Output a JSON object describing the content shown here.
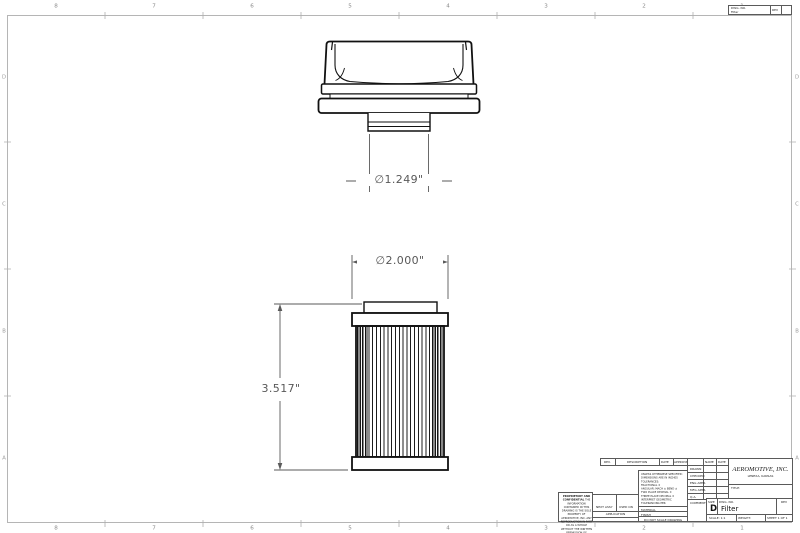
{
  "dimensions": {
    "cap_diameter": "∅1.249\"",
    "element_diameter": "∅2.000\"",
    "element_height": "3.517\""
  },
  "zones": {
    "top": [
      "8",
      "7",
      "6",
      "5",
      "4",
      "3",
      "2",
      "1"
    ],
    "bottom": [
      "8",
      "7",
      "6",
      "5",
      "4",
      "3",
      "2",
      "1"
    ],
    "left": [
      "D",
      "C",
      "B",
      "A"
    ],
    "right": [
      "D",
      "C",
      "B",
      "A"
    ]
  },
  "mini_strip": {
    "dwg_label": "DWG. NO.",
    "dwg_no": "Filter",
    "rev_label": "REV"
  },
  "title_block": {
    "rev_strip": {
      "rev": "REV.",
      "description": "DESCRIPTION",
      "date": "DATE",
      "approved": "APPROVED"
    },
    "approvals": {
      "name_label": "NAME",
      "date_label": "DATE",
      "rows": [
        "DRAWN",
        "CHECKED",
        "ENG APPR.",
        "MFG APPR.",
        "Q.A.",
        "COMMENTS:"
      ]
    },
    "tol_lines": [
      "UNLESS OTHERWISE SPECIFIED:",
      "DIMENSIONS ARE IN INCHES",
      "TOLERANCES:",
      "FRACTIONAL ±",
      "ANGULAR: MACH ±  BEND ±",
      "TWO PLACE DECIMAL    ±",
      "THREE PLACE DECIMAL  ±",
      "INTERPRET GEOMETRIC",
      "TOLERANCING PER:"
    ],
    "material_label": "MATERIAL",
    "finish_label": "FINISH",
    "do_not_scale": "DO NOT SCALE DRAWING",
    "proprietary_title": "PROPRIETARY AND CONFIDENTIAL",
    "proprietary_text": "THE INFORMATION CONTAINED IN THIS DRAWING IS THE SOLE PROPERTY OF AEROMOTIVE, INC.  ANY REPRODUCTION IN PART OR AS A WHOLE WITHOUT THE WRITTEN PERMISSION OF AEROMOTIVE, INC. IS PROHIBITED.",
    "next_assy": "NEXT ASSY",
    "used_on": "USED ON",
    "application": "APPLICATION",
    "company": "AEROMOTIVE, INC.",
    "company_sub": "LENEXA, KANSAS",
    "title_label": "TITLE:",
    "size_label": "SIZE",
    "size": "D",
    "dwg_label": "DWG. NO.",
    "dwg_no": "Filter",
    "rev_label": "REV",
    "scale": "SCALE: 1:1",
    "weight": "WEIGHT:",
    "sheet": "SHEET 1 OF 1"
  },
  "colors": {
    "line": "#111111",
    "dimension": "#585858",
    "border": "#b5b5b5"
  }
}
